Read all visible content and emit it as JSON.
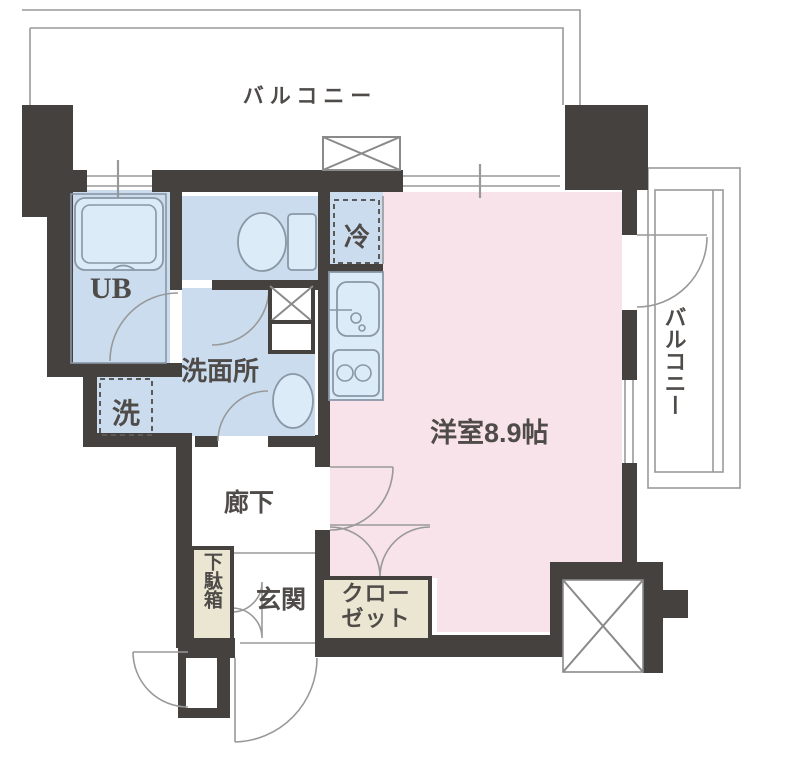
{
  "floor_plan": {
    "title": "ワンルーム間取り図",
    "labels": {
      "balcony_top": "バルコニー",
      "balcony_right": "バルコニー",
      "unit_bath": "UB",
      "washroom": "洗面所",
      "washer": "洗",
      "fridge": "冷",
      "main_room": "洋室8.9帖",
      "corridor": "廊下",
      "entrance": "玄関",
      "shoe_box": "下駄箱",
      "closet": "クローゼット"
    },
    "colors": {
      "wall": "#45413e",
      "room_blue": "#cadcee",
      "room_pink": "#f8e3ea",
      "closet_beige": "#eae6d2",
      "line_gray": "#999999",
      "fixture_fill": "#dcebf8",
      "text": "#4f4b49"
    }
  }
}
